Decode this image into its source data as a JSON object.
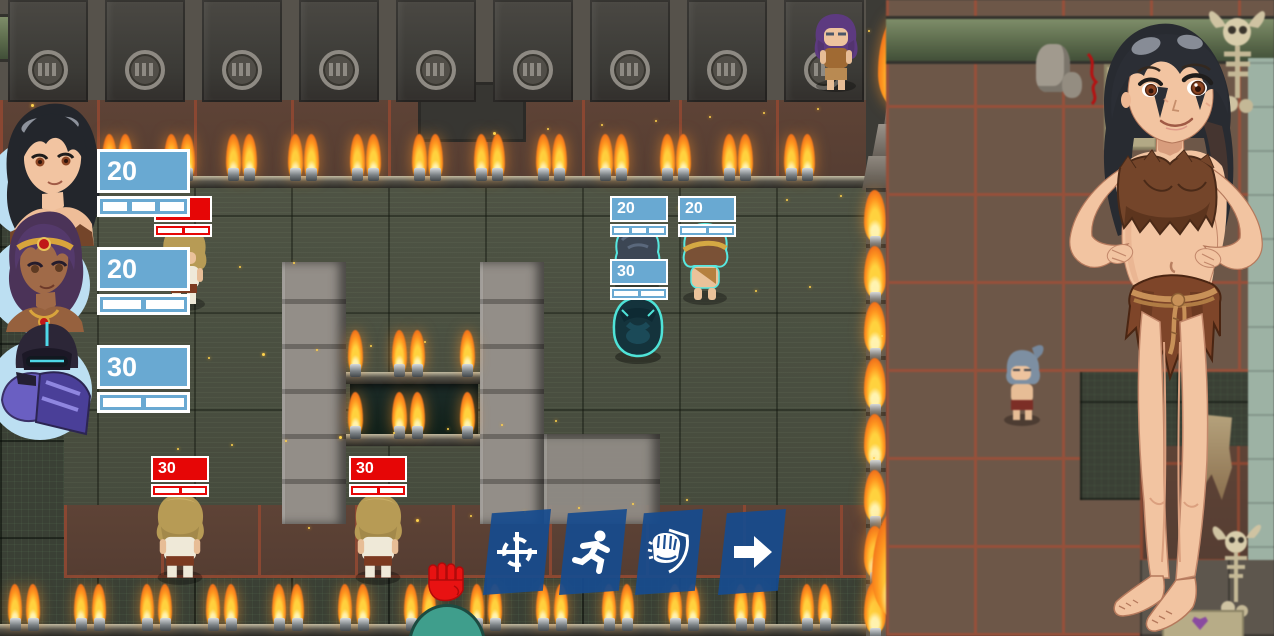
{
  "hud": {
    "party": [
      {
        "unit": "black-haired-girl",
        "hp": "20",
        "pips": 3
      },
      {
        "unit": "crowned-dark-skinned-girl",
        "hp": "20",
        "pips": 2
      },
      {
        "unit": "armored-android",
        "hp": "30",
        "pips": 2
      }
    ]
  },
  "battlefield": {
    "unit_bars": [
      {
        "unit": "blonde-grunt-upper",
        "style": "red",
        "hp": "30",
        "pips": 2
      },
      {
        "unit": "dark-haired-ally",
        "style": "blue",
        "hp": "20",
        "pips": 3
      },
      {
        "unit": "crowned-ally",
        "style": "blue",
        "hp": "20",
        "pips": 2
      },
      {
        "unit": "android-ally",
        "style": "blue",
        "hp": "30",
        "pips": 2
      },
      {
        "unit": "blonde-grunt-left",
        "style": "red",
        "hp": "30",
        "pips": 2
      },
      {
        "unit": "blonde-grunt-mid",
        "style": "red",
        "hp": "30",
        "pips": 2
      }
    ],
    "markers": [
      {
        "icon": "red-fist-attack-icon"
      }
    ]
  },
  "action_bar": {
    "buttons": [
      {
        "icon": "crosshair-target-icon"
      },
      {
        "icon": "run-icon"
      },
      {
        "icon": "fist-shield-icon"
      },
      {
        "icon": "arrow-right-icon"
      }
    ]
  },
  "colors": {
    "ally_hp": "#69a9d2",
    "enemy_hp": "#e60606",
    "action_button": "#174b8e",
    "hp_text": "#ffffff"
  }
}
